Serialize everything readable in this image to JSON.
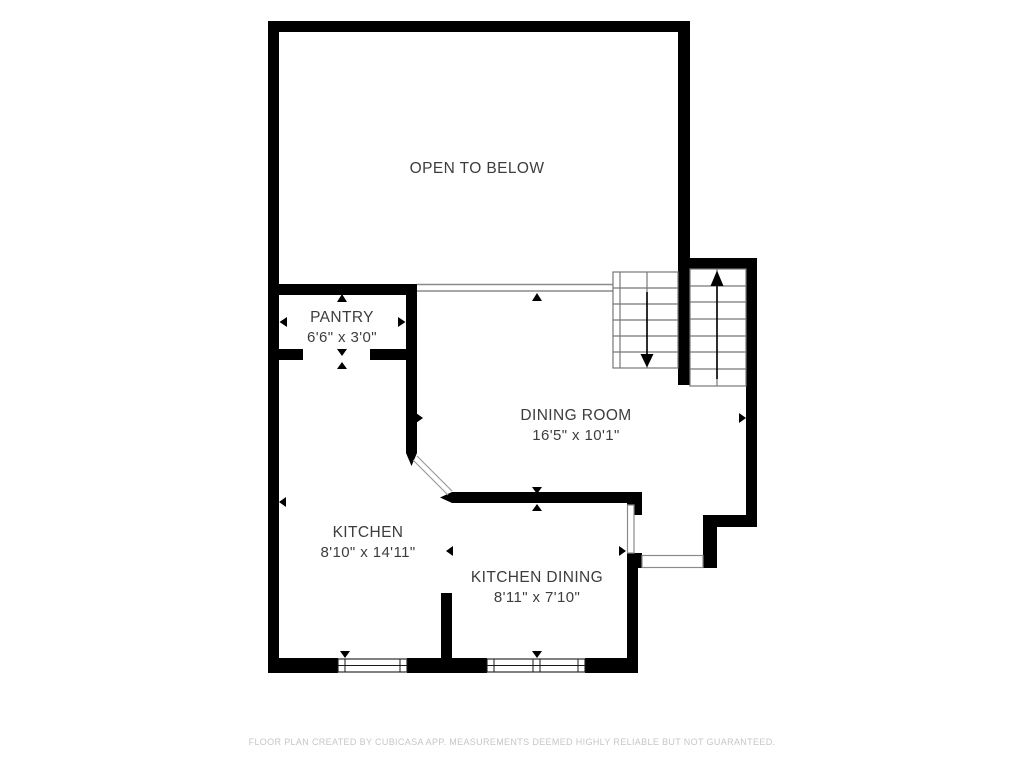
{
  "plan": {
    "open_area": {
      "label": "OPEN TO BELOW"
    },
    "rooms": [
      {
        "name": "PANTRY",
        "dims": "6'6\" x 3'0\""
      },
      {
        "name": "DINING ROOM",
        "dims": "16'5\" x 10'1\""
      },
      {
        "name": "KITCHEN",
        "dims": "8'10\" x 14'11\""
      },
      {
        "name": "KITCHEN DINING",
        "dims": "8'11\" x 7'10\""
      }
    ],
    "footer": "FLOOR PLAN CREATED BY CUBICASA APP. MEASUREMENTS DEEMED HIGHLY RELIABLE BUT NOT GUARANTEED.",
    "colors": {
      "wall": "#000000",
      "tread": "#777777",
      "railing": "#8a8a8a",
      "label": "#3d3d3d",
      "footer": "#c6c6c6"
    }
  }
}
